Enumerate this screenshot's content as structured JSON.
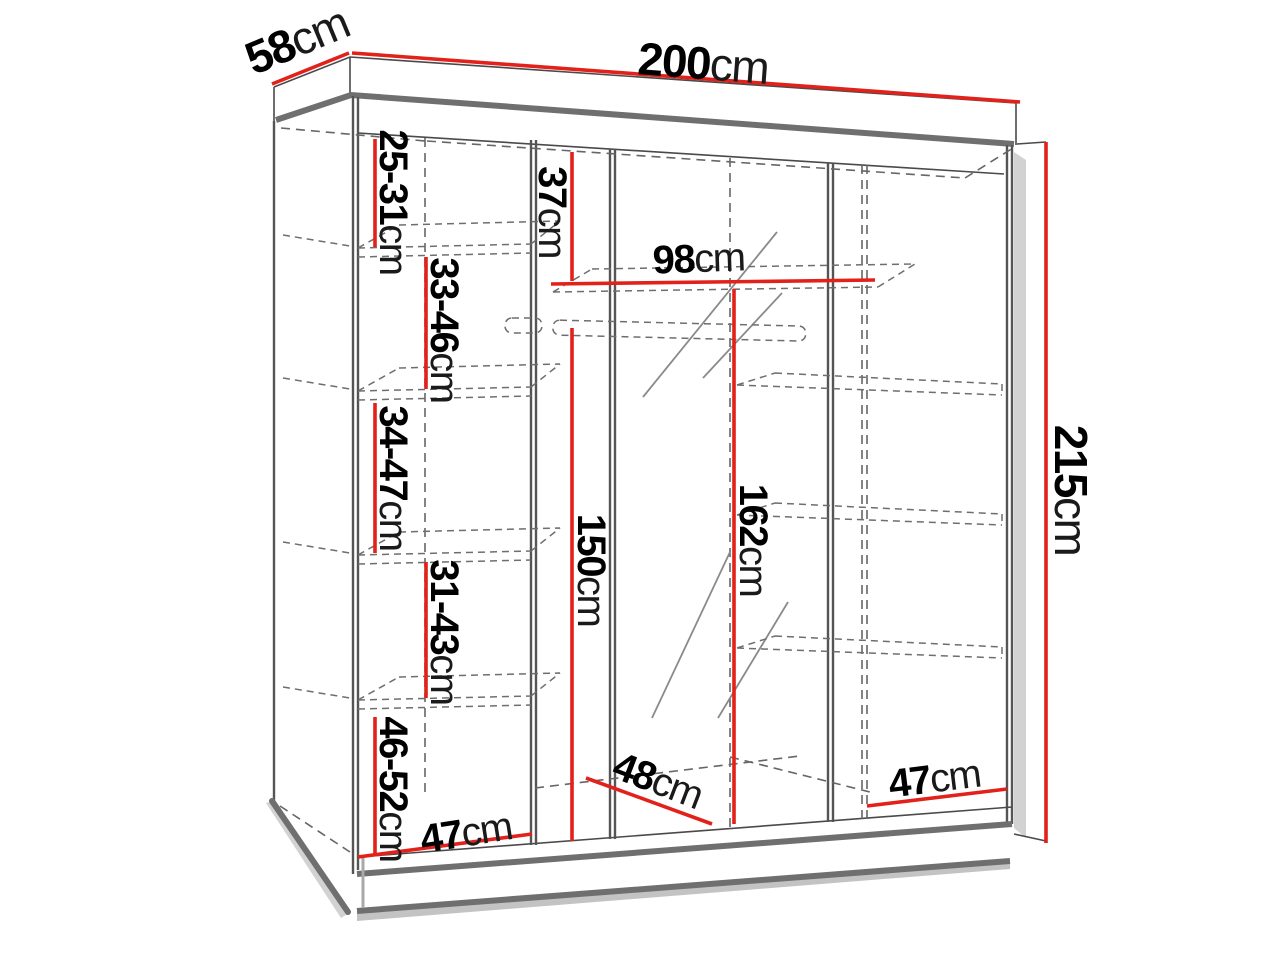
{
  "diagram": {
    "type": "furniture-dimension-diagram",
    "subject": "sliding-door wardrobe with mirror, interior shelves and hanging rail",
    "unit": "cm",
    "colors": {
      "dimension_line": "#e3211b",
      "outline": "#4a4a4a",
      "hidden_line": "#666666",
      "background": "#ffffff"
    },
    "dims": {
      "width": {
        "value": "200",
        "unit": "cm"
      },
      "depth": {
        "value": "58",
        "unit": "cm"
      },
      "height": {
        "value": "215",
        "unit": "cm"
      },
      "gap1": {
        "value": "25-31",
        "unit": "cm"
      },
      "gap2": {
        "value": "33-46",
        "unit": "cm"
      },
      "gap3": {
        "value": "34-47",
        "unit": "cm"
      },
      "gap4": {
        "value": "31-43",
        "unit": "cm"
      },
      "gap5": {
        "value": "46-52",
        "unit": "cm"
      },
      "top_section": {
        "value": "37",
        "unit": "cm"
      },
      "shelf_width": {
        "value": "98",
        "unit": "cm"
      },
      "hanging_space": {
        "value": "150",
        "unit": "cm"
      },
      "middle_section": {
        "value": "162",
        "unit": "cm"
      },
      "floor_left": {
        "value": "47",
        "unit": "cm"
      },
      "floor_middle": {
        "value": "48",
        "unit": "cm"
      },
      "floor_right": {
        "value": "47",
        "unit": "cm"
      }
    }
  }
}
